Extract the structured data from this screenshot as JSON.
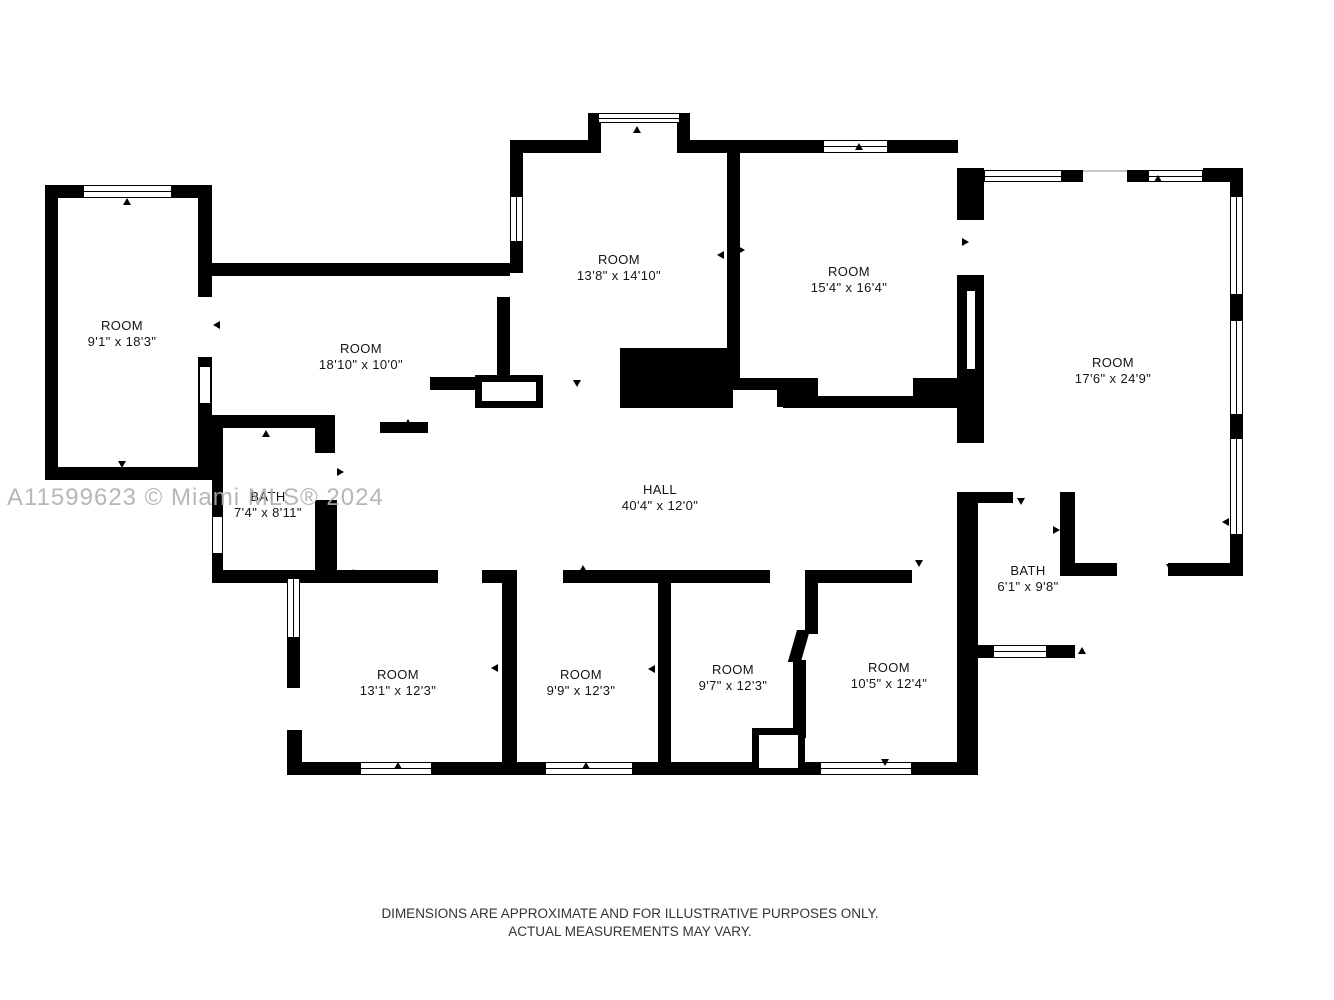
{
  "watermark": "A11599623 © Miami MLS® 2024",
  "footer": {
    "line1": "DIMENSIONS ARE APPROXIMATE AND FOR ILLUSTRATIVE PURPOSES ONLY.",
    "line2": "ACTUAL MEASUREMENTS MAY VARY."
  },
  "colors": {
    "wall": "#000000",
    "background": "#ffffff",
    "watermark": "#afafaf",
    "label_text": "#141414"
  },
  "rooms": [
    {
      "id": "room-9-1",
      "name": "ROOM",
      "dims": "9'1\" x 18'3\""
    },
    {
      "id": "room-18-10",
      "name": "ROOM",
      "dims": "18'10\" x 10'0\""
    },
    {
      "id": "room-13-8",
      "name": "ROOM",
      "dims": "13'8\" x 14'10\""
    },
    {
      "id": "room-15-4",
      "name": "ROOM",
      "dims": "15'4\" x 16'4\""
    },
    {
      "id": "room-17-6",
      "name": "ROOM",
      "dims": "17'6\" x 24'9\""
    },
    {
      "id": "bath-7-4",
      "name": "BATH",
      "dims": "7'4\" x 8'11\""
    },
    {
      "id": "hall",
      "name": "HALL",
      "dims": "40'4\" x 12'0\""
    },
    {
      "id": "bath-6-1",
      "name": "BATH",
      "dims": "6'1\" x 9'8\""
    },
    {
      "id": "room-13-1",
      "name": "ROOM",
      "dims": "13'1\" x 12'3\""
    },
    {
      "id": "room-9-9",
      "name": "ROOM",
      "dims": "9'9\" x 12'3\""
    },
    {
      "id": "room-9-7",
      "name": "ROOM",
      "dims": "9'7\" x 12'3\""
    },
    {
      "id": "room-10-5",
      "name": "ROOM",
      "dims": "10'5\" x 12'4\""
    }
  ]
}
